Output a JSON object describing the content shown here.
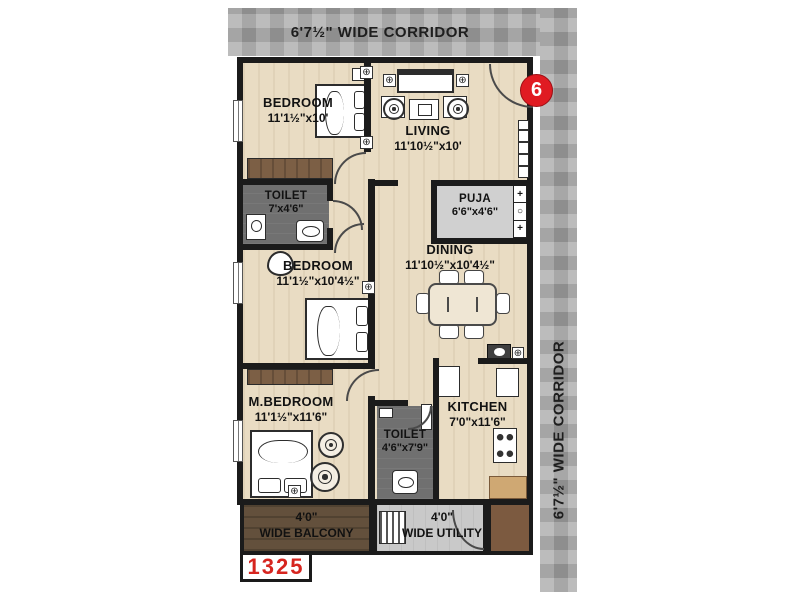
{
  "corridors": {
    "top": "6'7½\" WIDE CORRIDOR",
    "right": "6'7½\" WIDE CORRIDOR"
  },
  "unit_badge": {
    "number": "6",
    "color": "#e01b22"
  },
  "area_box": {
    "value": "1325",
    "color": "#d6251f"
  },
  "rooms": {
    "bedroom1": {
      "name": "BEDROOM",
      "dims": "11'1½\"x10'"
    },
    "living": {
      "name": "LIVING",
      "dims": "11'10½\"x10'"
    },
    "toilet1": {
      "name": "TOILET",
      "dims": "7'x4'6\""
    },
    "puja": {
      "name": "PUJA",
      "dims": "6'6\"x4'6\""
    },
    "bedroom2": {
      "name": "BEDROOM",
      "dims": "11'1½\"x10'4½\""
    },
    "dining": {
      "name": "DINING",
      "dims": "11'10½\"x10'4½\""
    },
    "mbedroom": {
      "name": "M.BEDROOM",
      "dims": "11'1½\"x11'6\""
    },
    "toilet2": {
      "name": "TOILET",
      "dims": "4'6\"x7'9\""
    },
    "kitchen": {
      "name": "KITCHEN",
      "dims": "7'0\"x11'6\""
    },
    "balcony": {
      "line1": "4'0\"",
      "line2": "WIDE BALCONY"
    },
    "utility": {
      "line1": "4'0\"",
      "line2": "WIDE UTILITY"
    }
  },
  "symbols": {
    "light_point": "⊕",
    "shelf_plus": "+",
    "shelf_circle": "○"
  },
  "colors": {
    "wall": "#1b1b1b",
    "floor": "#e9dcc3",
    "toilet_floor": "#707070",
    "puja_floor": "#d0d0d0",
    "utility_floor": "#c9c9c9",
    "balcony_floor": "#63503c",
    "corridor": "#a8a8a8",
    "wardrobe": "#7c5f45",
    "badge_red": "#e01b22",
    "area_red": "#d6251f"
  }
}
